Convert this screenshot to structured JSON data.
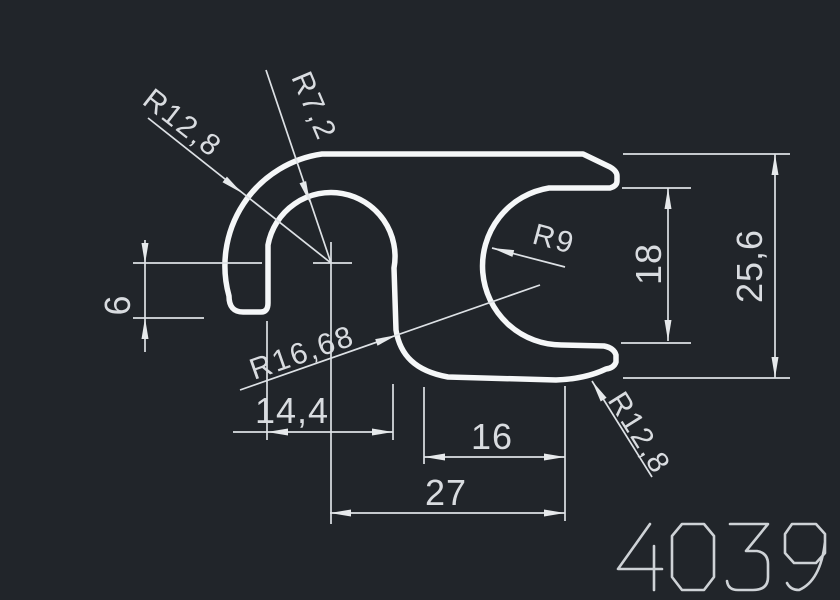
{
  "drawing": {
    "part_number": "4039",
    "radius_labels": {
      "top_left": "R12,8",
      "arch": "R7,2",
      "c_pocket": "R9",
      "s_curve": "R16,68",
      "bottom_right": "R12,8"
    },
    "linear_dims": {
      "left_offset": "6",
      "hook_width": "14,4",
      "slot_width": "16",
      "center_width": "27",
      "opening_height": "18",
      "total_height": "25,6"
    },
    "colors": {
      "background": "#21252a",
      "profile_line": "#f5f7f8",
      "dimension_line": "#dde1e5",
      "text": "#d9dce0"
    }
  }
}
